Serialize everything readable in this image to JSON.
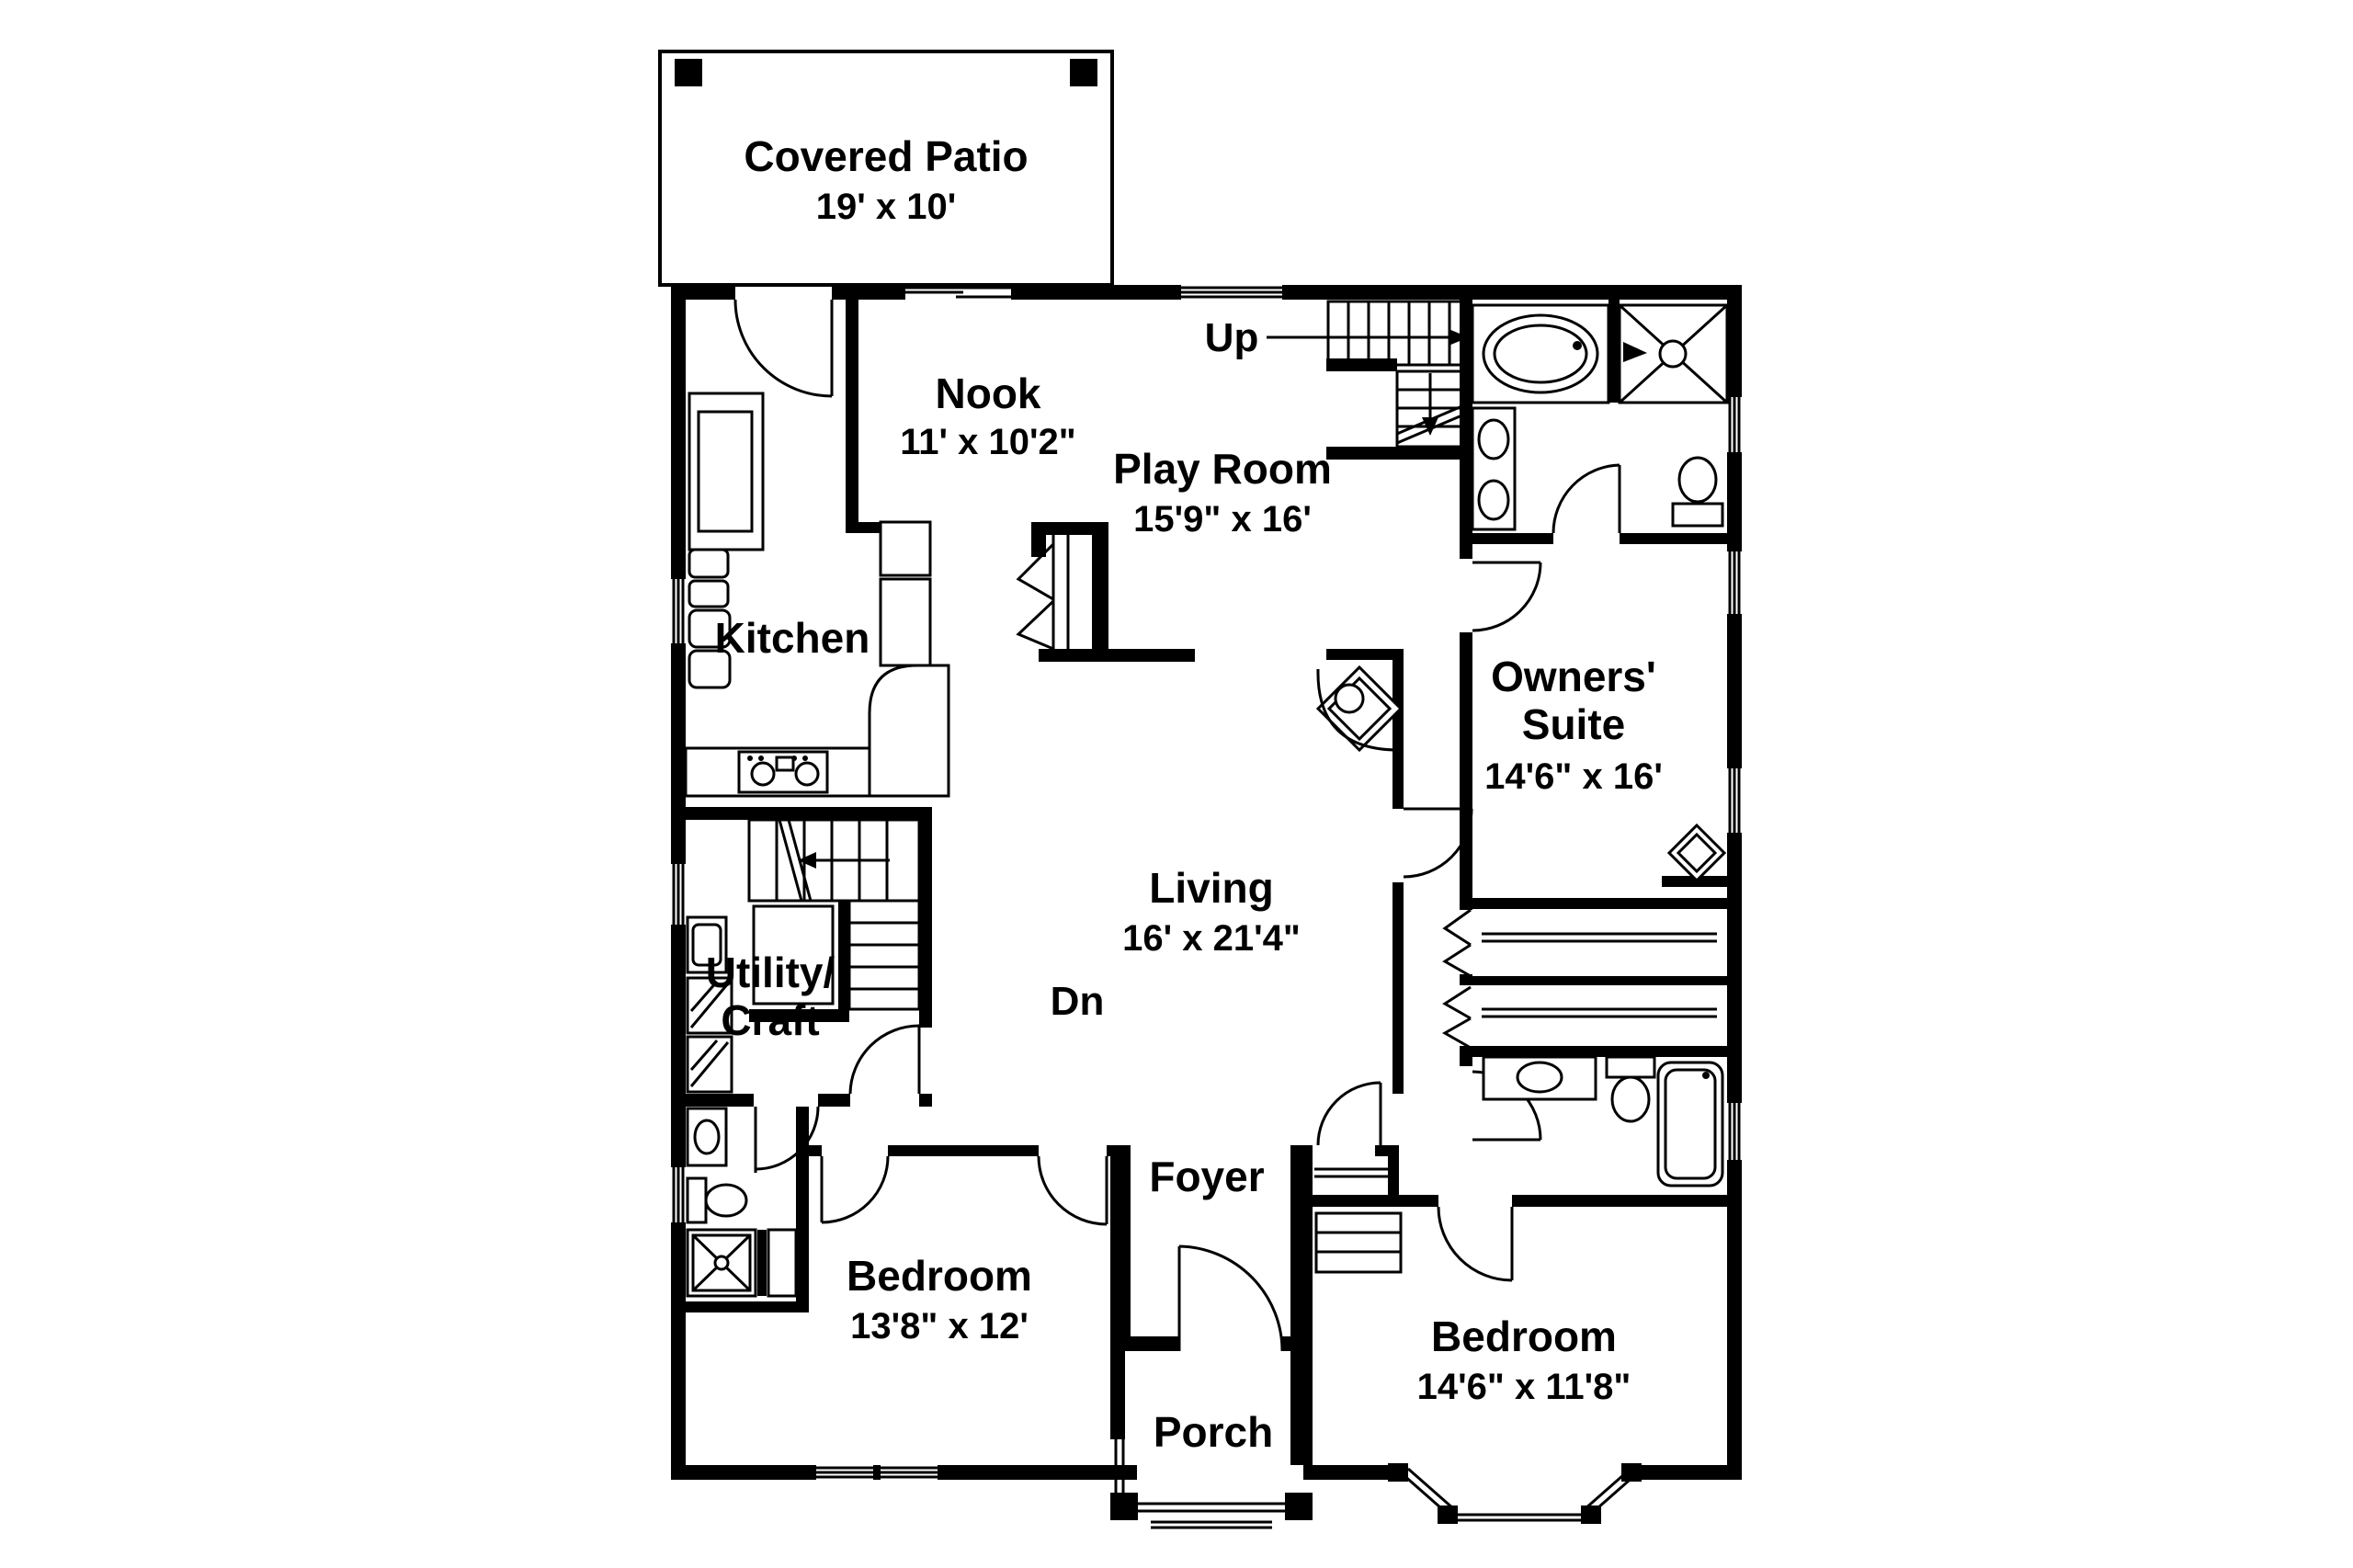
{
  "background": "#ffffff",
  "ink": "#000000",
  "rooms": {
    "covered_patio": {
      "name": "Covered Patio",
      "dims": "19' x 10'"
    },
    "nook": {
      "name": "Nook",
      "dims": "11' x 10'2\""
    },
    "play_room": {
      "name": "Play Room",
      "dims": "15'9\" x 16'"
    },
    "kitchen": {
      "name": "Kitchen"
    },
    "owners_suite": {
      "name_line1": "Owners'",
      "name_line2": "Suite",
      "dims": "14'6\" x 16'"
    },
    "living": {
      "name": "Living",
      "dims": "16' x 21'4\""
    },
    "utility_craft": {
      "name_line1": "Utility/",
      "name_line2": "Craft"
    },
    "foyer": {
      "name": "Foyer"
    },
    "bedroom_left": {
      "name": "Bedroom",
      "dims": "13'8\" x 12'"
    },
    "bedroom_right": {
      "name": "Bedroom",
      "dims": "14'6\" x 11'8\""
    },
    "porch": {
      "name": "Porch"
    }
  },
  "stairs": {
    "up_label": "Up",
    "down_label": "Dn"
  }
}
